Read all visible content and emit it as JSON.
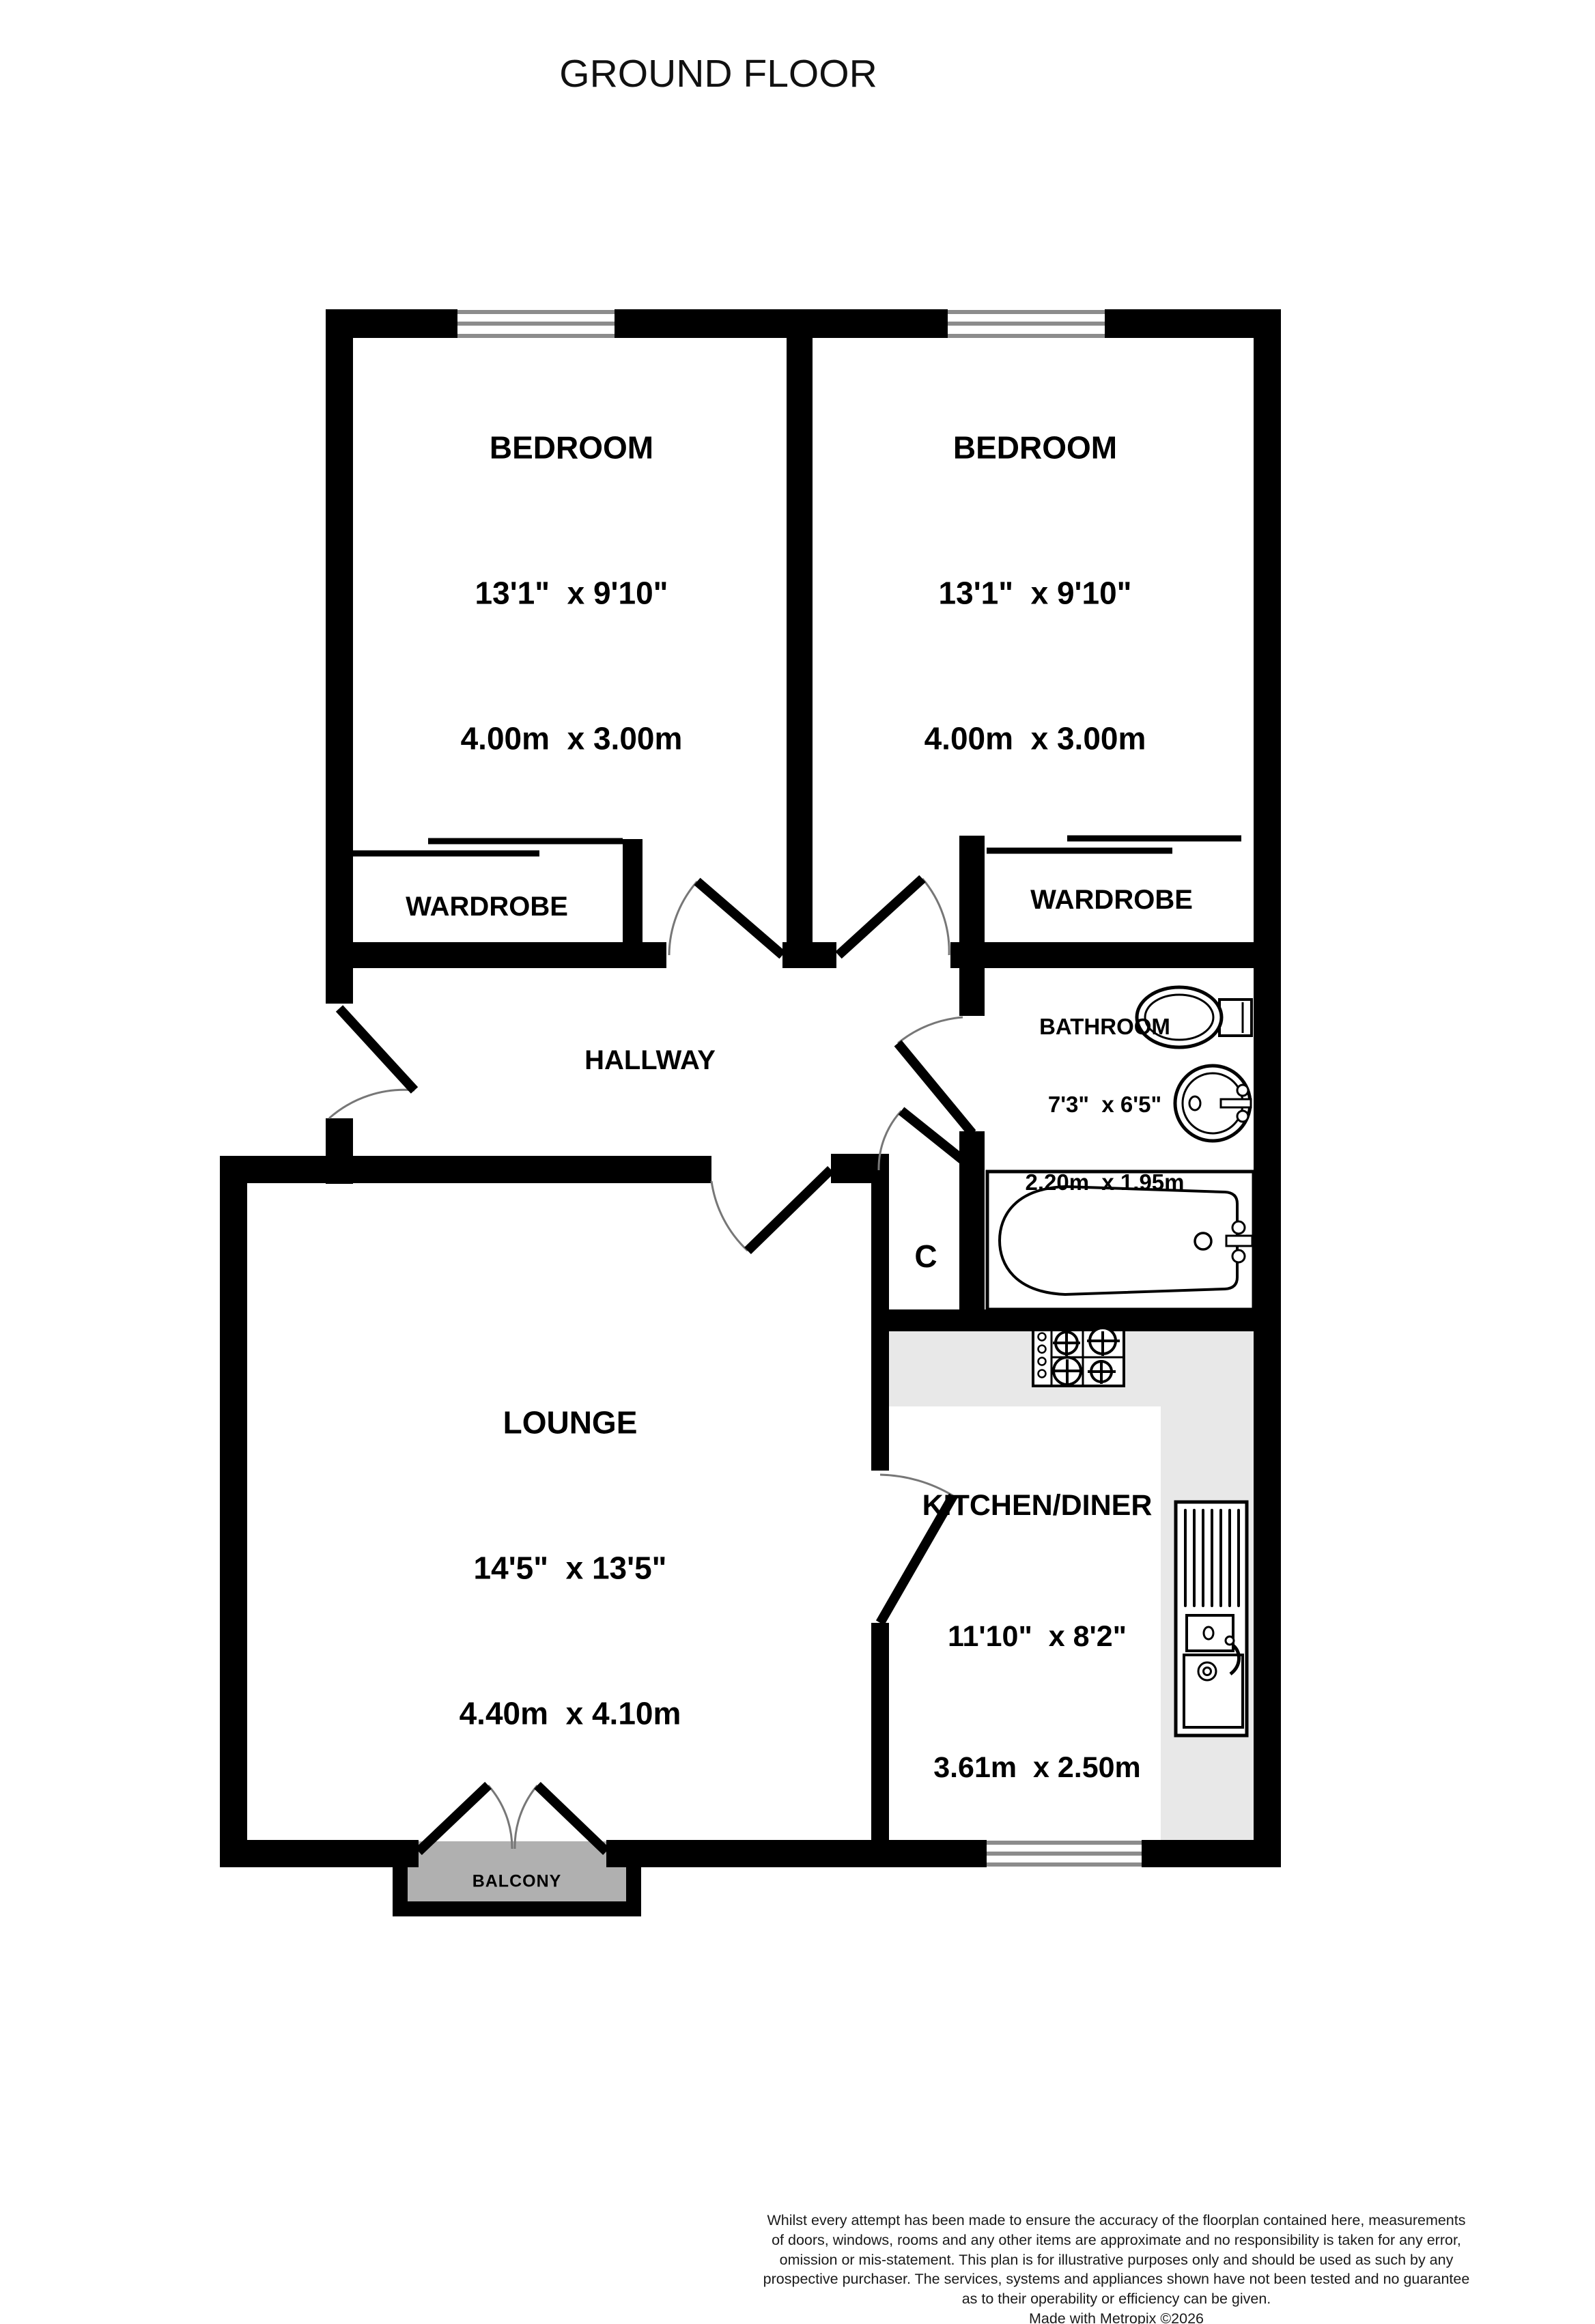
{
  "title": "GROUND FLOOR",
  "rooms": {
    "bedroom1": {
      "name": "BEDROOM",
      "imperial": "13'1\"  x 9'10\"",
      "metric": "4.00m  x 3.00m"
    },
    "bedroom2": {
      "name": "BEDROOM",
      "imperial": "13'1\"  x 9'10\"",
      "metric": "4.00m  x 3.00m"
    },
    "wardrobe1": {
      "name": "WARDROBE"
    },
    "wardrobe2": {
      "name": "WARDROBE"
    },
    "hallway": {
      "name": "HALLWAY"
    },
    "bathroom": {
      "name": "BATHROOM",
      "imperial": "7'3\"  x 6'5\"",
      "metric": "2.20m  x 1.95m"
    },
    "cupboard": {
      "name": "C"
    },
    "lounge": {
      "name": "LOUNGE",
      "imperial": "14'5\"  x 13'5\"",
      "metric": "4.40m  x 4.10m"
    },
    "kitchen": {
      "name": "KITCHEN/DINER",
      "imperial": "11'10\"  x 8'2\"",
      "metric": "3.61m  x 2.50m"
    },
    "balcony": {
      "name": "BALCONY"
    }
  },
  "footer": {
    "line1": "Whilst every attempt has been made to ensure the accuracy of the floorplan contained here, measurements",
    "line2": "of doors, windows, rooms and any other items are approximate and no responsibility is taken for any error,",
    "line3": "omission or mis-statement. This plan is for illustrative purposes only and should be used as such by any",
    "line4": "prospective purchaser. The services, systems and appliances shown have not been tested and no guarantee",
    "line5": "as to their operability or efficiency can be given.",
    "credit": "Made with Metropix ©2026"
  },
  "colors": {
    "wall": "#000000",
    "counter": "#e8e8e8",
    "balcony_deck": "#b0b0b0",
    "window_line": "#8c8c8c",
    "door_arc": "#777777"
  }
}
